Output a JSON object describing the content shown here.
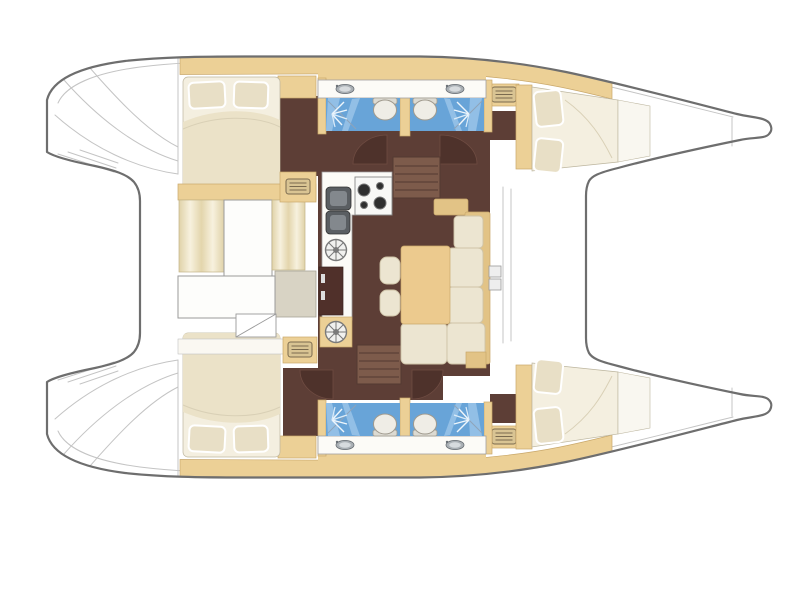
{
  "diagram": {
    "type": "floor-plan",
    "subject": "catamaran-yacht-interior-layout",
    "view": "top-down",
    "orientation": {
      "bow": "right",
      "stern": "left"
    }
  },
  "inventory": {
    "double_cabins": 4,
    "wet_rooms": 4,
    "toilets": 4,
    "showers": 4,
    "galleys": 1,
    "salon_tables": 1,
    "stairways": 2,
    "companionway_hatches": 4,
    "helm_wheel_vents": 2
  },
  "palette": {
    "hull-white": "#ffffff",
    "outline": "#6e6e6e",
    "inner-line": "#c4c4c4",
    "tan": "#ecd096",
    "tan-stroke": "#c9a86b",
    "tan-furniture": "#e2c386",
    "table-wood": "#ecca8e",
    "cushion": "#ece5d1",
    "cushion-stroke": "#cfc4a8",
    "bed-sheet": "#f4efe0",
    "mattress": "#ebe2c8",
    "pillow": "#e8dfc6",
    "floor-dark": "#5d3e36",
    "door-arc": "#4e322b",
    "stairs": "#7d5b4b",
    "stairs-line": "#543931",
    "water-blue": "#68a4d8",
    "water-blue-light": "#9cc6ea",
    "counter-white": "#fcfbf7",
    "fridge": "#50302a",
    "shelf-grey": "#d8d3c4"
  },
  "icons": [
    {
      "name": "companionway-steps-icon",
      "shape": "rounded rectangle with horizontal tread lines"
    },
    {
      "name": "helm-wheel-vent-icon",
      "shape": "circle with radial spokes and hub dot"
    },
    {
      "name": "shower-spray-icon",
      "shape": "white lines radiating on blue floor"
    },
    {
      "name": "toilet-icon",
      "shape": "oval bowl with tank bar"
    },
    {
      "name": "basin-sink-icon",
      "shape": "small grey ellipse in white counter"
    },
    {
      "name": "stove-burners-icon",
      "shape": "four circles on white hob panel"
    },
    {
      "name": "galley-double-sink-icon",
      "shape": "two dark rounded squares"
    },
    {
      "name": "door-swing-icon",
      "shape": "quarter-circle swing arc"
    }
  ]
}
